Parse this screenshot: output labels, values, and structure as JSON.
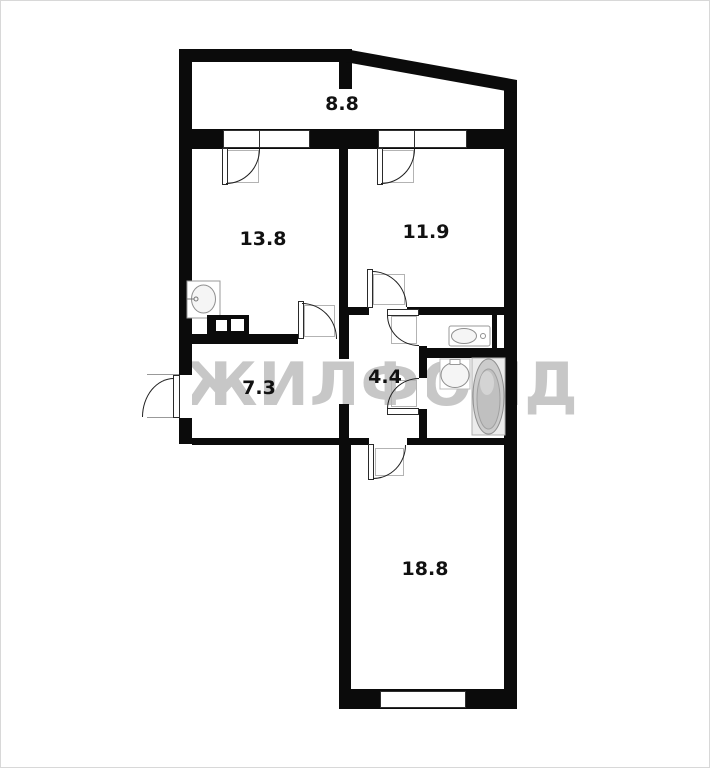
{
  "watermark": {
    "text": "ЖИЛФОНД"
  },
  "colors": {
    "wall": "#0b0b0b",
    "label": "#111111",
    "watermark": "#c7c7c7",
    "arc": "#1f1f1f",
    "frame": "#b3b3b3",
    "fixture": "#8f8f8f"
  },
  "rooms": [
    {
      "id": "balcony",
      "area": "8.8"
    },
    {
      "id": "kitchen",
      "area": "13.8"
    },
    {
      "id": "bedroom",
      "area": "11.9"
    },
    {
      "id": "hallway",
      "area": "7.3"
    },
    {
      "id": "corridor",
      "area": "4.4"
    },
    {
      "id": "living-room",
      "area": "18.8"
    }
  ],
  "fixture_icons": [
    "kitchen-sink-icon",
    "stove-icon",
    "toilet-icon",
    "washbasin-icon",
    "bathtub-icon"
  ]
}
